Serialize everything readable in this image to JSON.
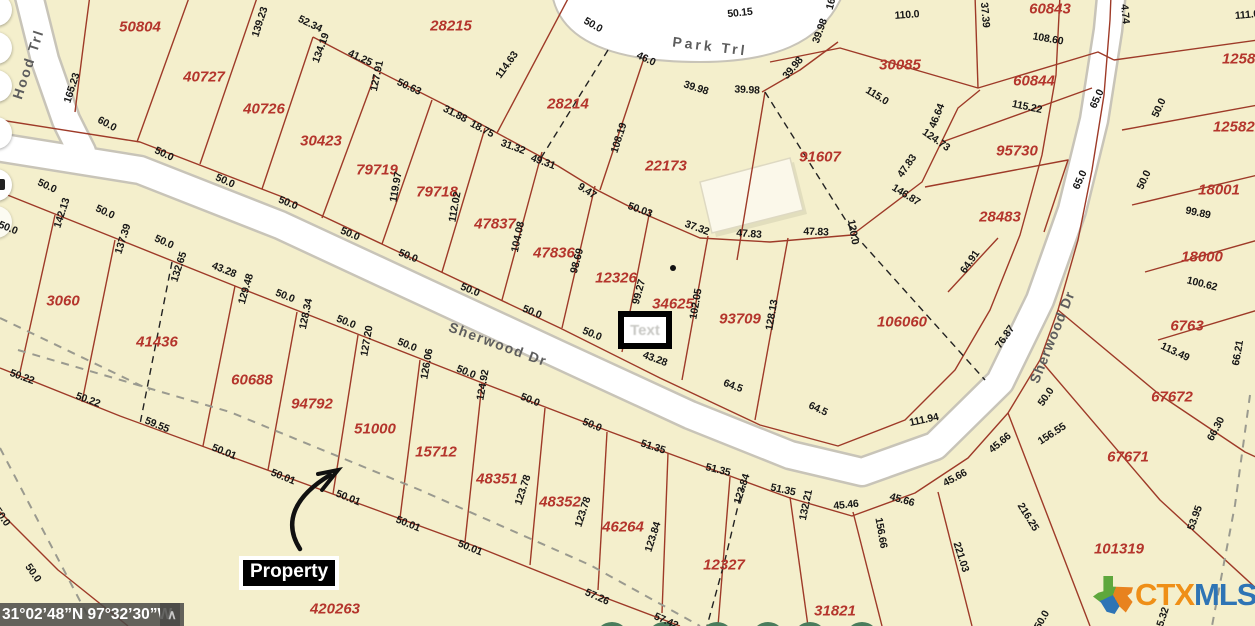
{
  "map": {
    "colors": {
      "background": "#f4efcc",
      "parcel_line": "#9e3a28",
      "lot_text": "#b4352c",
      "dim_text": "#161616",
      "road_fill": "#ffffff",
      "road_casing": "#c8c4b8",
      "logo_orange": "#ef8f17",
      "logo_blue": "#2e74b5",
      "tree_green": "#4a7c5c"
    },
    "streets": [
      {
        "name": "Hood Trl",
        "x": 28,
        "y": 64,
        "rot": -72,
        "spacing": 2
      },
      {
        "name": "Park Trl",
        "x": 710,
        "y": 46,
        "rot": 7,
        "spacing": 3
      },
      {
        "name": "Sherwood Dr",
        "x": 498,
        "y": 344,
        "rot": 20,
        "spacing": 1.5
      },
      {
        "name": "Sherwood Dr",
        "x": 1052,
        "y": 337,
        "rot": -68,
        "spacing": 1
      }
    ],
    "lots": [
      {
        "id": "50804",
        "x": 140,
        "y": 27
      },
      {
        "id": "40727",
        "x": 204,
        "y": 77
      },
      {
        "id": "40726",
        "x": 264,
        "y": 109
      },
      {
        "id": "30423",
        "x": 321,
        "y": 141
      },
      {
        "id": "79719",
        "x": 377,
        "y": 170
      },
      {
        "id": "79718",
        "x": 437,
        "y": 192
      },
      {
        "id": "47837",
        "x": 495,
        "y": 224
      },
      {
        "id": "47836",
        "x": 554,
        "y": 253
      },
      {
        "id": "12326",
        "x": 616,
        "y": 278
      },
      {
        "id": "28215",
        "x": 451,
        "y": 26
      },
      {
        "id": "28214",
        "x": 568,
        "y": 104
      },
      {
        "id": "22173",
        "x": 666,
        "y": 166
      },
      {
        "id": "91607",
        "x": 820,
        "y": 157
      },
      {
        "id": "30085",
        "x": 900,
        "y": 65
      },
      {
        "id": "60843",
        "x": 1050,
        "y": 9
      },
      {
        "id": "60844",
        "x": 1034,
        "y": 81
      },
      {
        "id": "95730",
        "x": 1017,
        "y": 151
      },
      {
        "id": "28483",
        "x": 1000,
        "y": 217
      },
      {
        "id": "106060",
        "x": 902,
        "y": 322
      },
      {
        "id": "93709",
        "x": 740,
        "y": 319
      },
      {
        "id": "34625",
        "x": 673,
        "y": 304
      },
      {
        "id": "125821",
        "x": 1247,
        "y": 59
      },
      {
        "id": "125821",
        "x": 1238,
        "y": 127
      },
      {
        "id": "18001",
        "x": 1219,
        "y": 190
      },
      {
        "id": "18000",
        "x": 1202,
        "y": 257
      },
      {
        "id": "6763",
        "x": 1187,
        "y": 326
      },
      {
        "id": "67672",
        "x": 1172,
        "y": 397
      },
      {
        "id": "67671",
        "x": 1128,
        "y": 457
      },
      {
        "id": "101319",
        "x": 1119,
        "y": 549
      },
      {
        "id": "3060",
        "x": 63,
        "y": 301
      },
      {
        "id": "41436",
        "x": 157,
        "y": 342
      },
      {
        "id": "60688",
        "x": 252,
        "y": 380
      },
      {
        "id": "94792",
        "x": 312,
        "y": 404
      },
      {
        "id": "51000",
        "x": 375,
        "y": 429
      },
      {
        "id": "15712",
        "x": 436,
        "y": 452
      },
      {
        "id": "48351",
        "x": 497,
        "y": 479
      },
      {
        "id": "48352",
        "x": 560,
        "y": 502
      },
      {
        "id": "46264",
        "x": 623,
        "y": 527
      },
      {
        "id": "12327",
        "x": 724,
        "y": 565
      },
      {
        "id": "31821",
        "x": 835,
        "y": 611
      },
      {
        "id": "420263",
        "x": 335,
        "y": 609
      }
    ],
    "dimensions": [
      {
        "t": "165.23",
        "x": 72,
        "y": 88,
        "r": -72
      },
      {
        "t": "139.23",
        "x": 260,
        "y": 22,
        "r": -72
      },
      {
        "t": "52.34",
        "x": 310,
        "y": 24,
        "r": 26
      },
      {
        "t": "134.19",
        "x": 321,
        "y": 48,
        "r": -70
      },
      {
        "t": "41.25",
        "x": 360,
        "y": 58,
        "r": 25
      },
      {
        "t": "127.91",
        "x": 377,
        "y": 76,
        "r": -78
      },
      {
        "t": "50.63",
        "x": 409,
        "y": 87,
        "r": 25
      },
      {
        "t": "114.63",
        "x": 507,
        "y": 65,
        "r": -54
      },
      {
        "t": "31.88",
        "x": 455,
        "y": 114,
        "r": 27
      },
      {
        "t": "18.75",
        "x": 482,
        "y": 129,
        "r": 28
      },
      {
        "t": "31.32",
        "x": 513,
        "y": 147,
        "r": 20
      },
      {
        "t": "49.31",
        "x": 543,
        "y": 162,
        "r": 20
      },
      {
        "t": "119.97",
        "x": 396,
        "y": 187,
        "r": -80
      },
      {
        "t": "112.02",
        "x": 455,
        "y": 207,
        "r": -80
      },
      {
        "t": "104.08",
        "x": 518,
        "y": 237,
        "r": -78
      },
      {
        "t": "98.69",
        "x": 577,
        "y": 261,
        "r": -75
      },
      {
        "t": "108.19",
        "x": 619,
        "y": 138,
        "r": -72
      },
      {
        "t": "9.47",
        "x": 587,
        "y": 191,
        "r": 33
      },
      {
        "t": "50.03",
        "x": 640,
        "y": 210,
        "r": 20
      },
      {
        "t": "37.32",
        "x": 697,
        "y": 228,
        "r": 20
      },
      {
        "t": "47.83",
        "x": 749,
        "y": 234,
        "r": 4
      },
      {
        "t": "47.83",
        "x": 816,
        "y": 232,
        "r": 2
      },
      {
        "t": "47.83",
        "x": 907,
        "y": 166,
        "r": -55
      },
      {
        "t": "146.87",
        "x": 906,
        "y": 195,
        "r": 32
      },
      {
        "t": "120.0",
        "x": 853,
        "y": 232,
        "r": 80
      },
      {
        "t": "115.0",
        "x": 877,
        "y": 96,
        "r": 32
      },
      {
        "t": "46.64",
        "x": 937,
        "y": 116,
        "r": -68
      },
      {
        "t": "124.73",
        "x": 936,
        "y": 140,
        "r": 35
      },
      {
        "t": "110.0",
        "x": 907,
        "y": 15,
        "r": -4
      },
      {
        "t": "37.39",
        "x": 985,
        "y": 15,
        "r": 85
      },
      {
        "t": "108.60",
        "x": 1048,
        "y": 39,
        "r": 10
      },
      {
        "t": "115.22",
        "x": 1027,
        "y": 107,
        "r": 12
      },
      {
        "t": "65.0",
        "x": 1097,
        "y": 99,
        "r": -65
      },
      {
        "t": "65.0",
        "x": 1080,
        "y": 180,
        "r": -65
      },
      {
        "t": "4.74",
        "x": 1125,
        "y": 14,
        "r": 85
      },
      {
        "t": "111.0",
        "x": 1247,
        "y": 15,
        "r": -5
      },
      {
        "t": "50.0",
        "x": 1159,
        "y": 108,
        "r": -65
      },
      {
        "t": "50.0",
        "x": 1144,
        "y": 180,
        "r": -65
      },
      {
        "t": "99.89",
        "x": 1198,
        "y": 213,
        "r": 12
      },
      {
        "t": "100.62",
        "x": 1202,
        "y": 284,
        "r": 14
      },
      {
        "t": "113.49",
        "x": 1175,
        "y": 352,
        "r": 25
      },
      {
        "t": "66.21",
        "x": 1238,
        "y": 353,
        "r": -80
      },
      {
        "t": "66.30",
        "x": 1216,
        "y": 429,
        "r": -62
      },
      {
        "t": "53.95",
        "x": 1195,
        "y": 518,
        "r": -70
      },
      {
        "t": "16",
        "x": 831,
        "y": 4,
        "r": -75
      },
      {
        "t": "50.15",
        "x": 740,
        "y": 13,
        "r": -6
      },
      {
        "t": "50.0",
        "x": 593,
        "y": 25,
        "r": 30
      },
      {
        "t": "46.0",
        "x": 646,
        "y": 59,
        "r": 25
      },
      {
        "t": "39.98",
        "x": 696,
        "y": 88,
        "r": 18
      },
      {
        "t": "39.98",
        "x": 747,
        "y": 90,
        "r": 3
      },
      {
        "t": "39.98",
        "x": 793,
        "y": 68,
        "r": -50
      },
      {
        "t": "39.98",
        "x": 820,
        "y": 31,
        "r": -70
      },
      {
        "t": "60.0",
        "x": 107,
        "y": 124,
        "r": 28
      },
      {
        "t": "50.0",
        "x": 164,
        "y": 154,
        "r": 25
      },
      {
        "t": "50.0",
        "x": 225,
        "y": 181,
        "r": 24
      },
      {
        "t": "50.0",
        "x": 288,
        "y": 203,
        "r": 22
      },
      {
        "t": "50.0",
        "x": 350,
        "y": 234,
        "r": 22
      },
      {
        "t": "50.0",
        "x": 408,
        "y": 256,
        "r": 22
      },
      {
        "t": "50.0",
        "x": 470,
        "y": 290,
        "r": 22
      },
      {
        "t": "50.0",
        "x": 532,
        "y": 312,
        "r": 22
      },
      {
        "t": "50.0",
        "x": 592,
        "y": 334,
        "r": 22
      },
      {
        "t": "43.28",
        "x": 655,
        "y": 359,
        "r": 20
      },
      {
        "t": "99.27",
        "x": 639,
        "y": 292,
        "r": -75
      },
      {
        "t": "102.05",
        "x": 696,
        "y": 304,
        "r": -80
      },
      {
        "t": "128.13",
        "x": 772,
        "y": 315,
        "r": -80
      },
      {
        "t": "64.5",
        "x": 733,
        "y": 386,
        "r": 20
      },
      {
        "t": "64.5",
        "x": 818,
        "y": 409,
        "r": 25
      },
      {
        "t": "64.91",
        "x": 970,
        "y": 262,
        "r": -55
      },
      {
        "t": "76.87",
        "x": 1005,
        "y": 337,
        "r": -55
      },
      {
        "t": "111.94",
        "x": 924,
        "y": 420,
        "r": -12
      },
      {
        "t": "45.46",
        "x": 846,
        "y": 505,
        "r": -6
      },
      {
        "t": "45.66",
        "x": 902,
        "y": 500,
        "r": 16
      },
      {
        "t": "45.66",
        "x": 955,
        "y": 478,
        "r": -28
      },
      {
        "t": "45.66",
        "x": 1000,
        "y": 443,
        "r": -40
      },
      {
        "t": "50.0",
        "x": 1046,
        "y": 397,
        "r": -55
      },
      {
        "t": "156.55",
        "x": 1052,
        "y": 434,
        "r": -33
      },
      {
        "t": "156.66",
        "x": 881,
        "y": 533,
        "r": 80
      },
      {
        "t": "221.03",
        "x": 961,
        "y": 557,
        "r": 72
      },
      {
        "t": "216.25",
        "x": 1028,
        "y": 517,
        "r": 58
      },
      {
        "t": "50.0",
        "x": 47,
        "y": 186,
        "r": 25
      },
      {
        "t": "50.0",
        "x": 105,
        "y": 212,
        "r": 25
      },
      {
        "t": "50.0",
        "x": 164,
        "y": 242,
        "r": 24
      },
      {
        "t": "43.28",
        "x": 224,
        "y": 270,
        "r": 22
      },
      {
        "t": "50.0",
        "x": 285,
        "y": 296,
        "r": 22
      },
      {
        "t": "50.0",
        "x": 346,
        "y": 322,
        "r": 22
      },
      {
        "t": "50.0",
        "x": 407,
        "y": 345,
        "r": 22
      },
      {
        "t": "50.0",
        "x": 466,
        "y": 372,
        "r": 22
      },
      {
        "t": "50.0",
        "x": 530,
        "y": 400,
        "r": 22
      },
      {
        "t": "50.0",
        "x": 592,
        "y": 425,
        "r": 22
      },
      {
        "t": "51.35",
        "x": 653,
        "y": 447,
        "r": 18
      },
      {
        "t": "51.35",
        "x": 718,
        "y": 470,
        "r": 14
      },
      {
        "t": "51.35",
        "x": 783,
        "y": 490,
        "r": 12
      },
      {
        "t": "142.13",
        "x": 62,
        "y": 213,
        "r": -72
      },
      {
        "t": "137.39",
        "x": 123,
        "y": 239,
        "r": -72
      },
      {
        "t": "132.65",
        "x": 179,
        "y": 267,
        "r": -72
      },
      {
        "t": "129.48",
        "x": 246,
        "y": 289,
        "r": -74
      },
      {
        "t": "128.34",
        "x": 306,
        "y": 314,
        "r": -78
      },
      {
        "t": "127.20",
        "x": 367,
        "y": 341,
        "r": -80
      },
      {
        "t": "126.06",
        "x": 427,
        "y": 364,
        "r": -80
      },
      {
        "t": "124.92",
        "x": 483,
        "y": 385,
        "r": -80
      },
      {
        "t": "123.78",
        "x": 523,
        "y": 490,
        "r": -72
      },
      {
        "t": "123.78",
        "x": 583,
        "y": 512,
        "r": -72
      },
      {
        "t": "123.84",
        "x": 653,
        "y": 537,
        "r": -72
      },
      {
        "t": "123.84",
        "x": 742,
        "y": 489,
        "r": -72
      },
      {
        "t": "132.21",
        "x": 806,
        "y": 505,
        "r": -78
      },
      {
        "t": "50.0",
        "x": 8,
        "y": 228,
        "r": 22
      },
      {
        "t": "50.22",
        "x": 22,
        "y": 377,
        "r": 20
      },
      {
        "t": "50.22",
        "x": 88,
        "y": 400,
        "r": 20
      },
      {
        "t": "59.55",
        "x": 157,
        "y": 425,
        "r": 22
      },
      {
        "t": "50.01",
        "x": 224,
        "y": 452,
        "r": 22
      },
      {
        "t": "50.01",
        "x": 283,
        "y": 477,
        "r": 22
      },
      {
        "t": "50.01",
        "x": 348,
        "y": 498,
        "r": 22
      },
      {
        "t": "50.01",
        "x": 408,
        "y": 524,
        "r": 22
      },
      {
        "t": "50.01",
        "x": 470,
        "y": 548,
        "r": 22
      },
      {
        "t": "57.26",
        "x": 597,
        "y": 597,
        "r": 24
      },
      {
        "t": "57.42",
        "x": 666,
        "y": 621,
        "r": 24
      },
      {
        "t": "50.0",
        "x": 33,
        "y": 573,
        "r": 55
      },
      {
        "t": "50.0",
        "x": 2,
        "y": 517,
        "r": 55
      },
      {
        "t": "5.32",
        "x": 1163,
        "y": 617,
        "r": -72
      },
      {
        "t": "50.0",
        "x": 1042,
        "y": 620,
        "r": -60
      }
    ],
    "marker": {
      "watermark_text": "Text"
    },
    "annotation": {
      "property_label": "Property"
    },
    "coordinates_bar": {
      "text": "31°02’48”N 97°32’30”W",
      "caret": "∧"
    },
    "logo": {
      "ctx": "CTX",
      "mls": "MLS",
      "texas_icon": "texas-state-icon"
    }
  }
}
